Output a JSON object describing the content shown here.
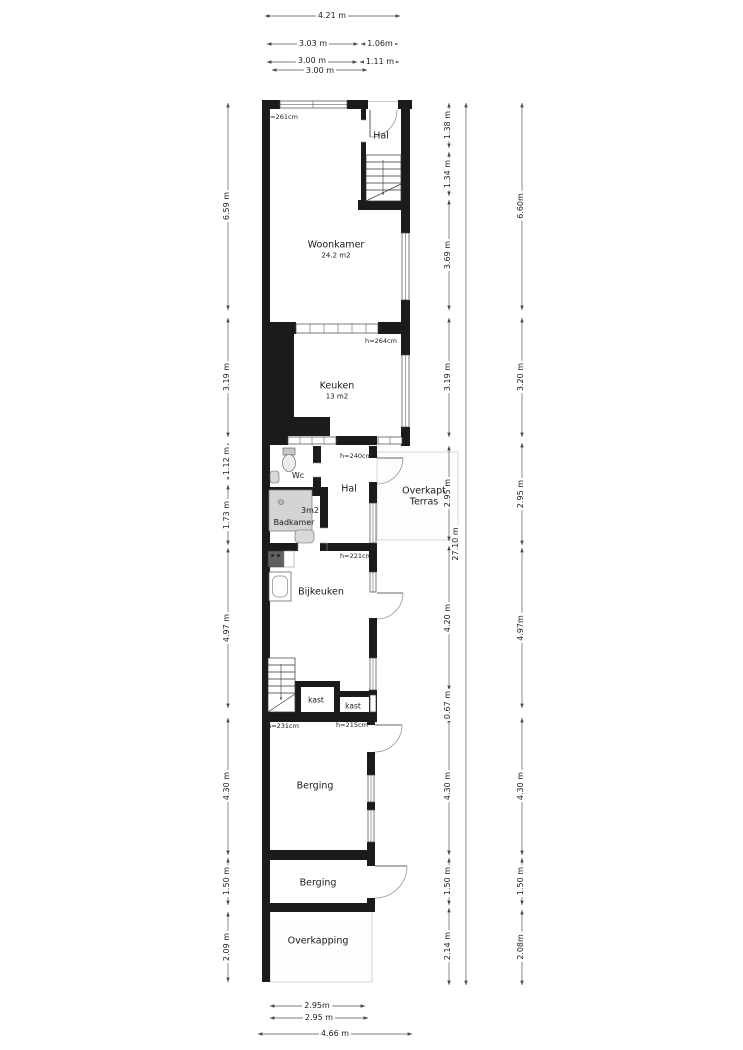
{
  "rooms": {
    "hal_top": "Hal",
    "woonkamer": "Woonkamer",
    "woonkamer_area": "24.2 m2",
    "keuken": "Keuken",
    "keuken_area": "13 m2",
    "wc": "Wc",
    "hal_mid": "Hal",
    "badkamer": "Badkamer",
    "badkamer_area": "3m2",
    "terras_line1": "Overkapt",
    "terras_line2": "Terras",
    "bijkeuken": "Bijkeuken",
    "kast1": "kast",
    "kast2": "kast",
    "berging1": "Berging",
    "berging2": "Berging",
    "overkapping": "Overkapping"
  },
  "heights": {
    "woonkamer": "h=261cm",
    "keuken": "h=264cm",
    "hal": "h=240cm",
    "bijkeuken": "h=221cm",
    "berging_left": "h=231cm",
    "berging_right": "h=215cm"
  },
  "dimensions": {
    "top": [
      "4.21 m",
      "3.03 m",
      "1.06m",
      "3.00 m",
      "1.11 m",
      "3.00 m"
    ],
    "left": [
      "6.59 m",
      "3.19 m",
      "1.12 m",
      "1.73 m",
      "4.97 m",
      "4.30 m",
      "1.50 m",
      "2.09 m"
    ],
    "right_inner": [
      "1.38 m",
      "1.34 m",
      "3.69 m",
      "3.19 m",
      "2.95 m",
      "4.20 m",
      "0.67 m",
      "4.30 m",
      "1.50 m",
      "2.14 m"
    ],
    "right_total": "27.10 m",
    "right_outer": [
      "6.60m",
      "3.20 m",
      "2.95 m",
      "4.97m",
      "4.30 m",
      "1.50 m",
      "2.08m"
    ],
    "bottom": [
      "2.95m",
      "2.95 m",
      "4.66 m"
    ]
  },
  "colors": {
    "wall": "#1b1b1b",
    "dimension_line": "#555555",
    "shower_fill": "#d4d4d4",
    "light_outline": "#d8d8d8"
  }
}
